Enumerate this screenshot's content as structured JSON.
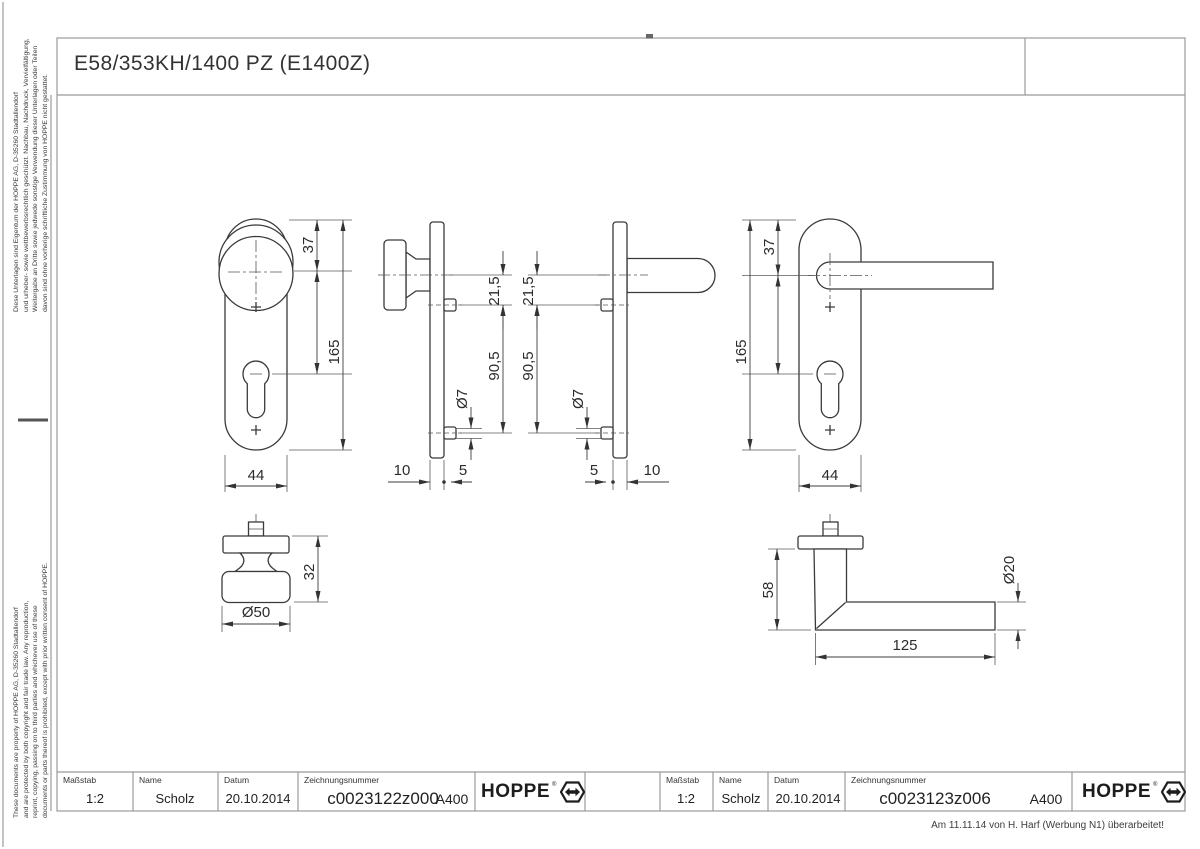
{
  "title": "E58/353KH/1400 PZ (E1400Z)",
  "revision_note": "Am 11.11.14 von H. Harf (Werbung N1) überarbeitet!",
  "brand": {
    "name": "HOPPE",
    "registered_mark": "®",
    "logo_icon": "hoppe-hexagon-arrow-icon"
  },
  "legal": {
    "german": [
      "Diese Unterlagen sind Eigentum der HOPPE AG, D-35260 Stadtallendorf",
      "und urheber- sowie wettbewerbsrechtlich geschützt. Nachbau, Nachdruck, Vervielfältigung,",
      "Weitergabe an Dritte sowie jedwede sonstige Verwendung dieser Unterlagen oder Teilen",
      "davon sind ohne vorherige schriftliche Zustimmung von HOPPE nicht gestattet."
    ],
    "english": [
      "These documents are property of HOPPE AG, D-35260 Stadtallendorf",
      "and are protected by both copyright and fair trade law. Any reproduction,",
      "reprint, copying, passing on to third parties and whichever use of these",
      "documents or parts thereof is prohibited, except with prior written consent of HOPPE."
    ]
  },
  "title_blocks": [
    {
      "scale_label": "Maßstab",
      "scale_value": "1:2",
      "name_label": "Name",
      "name_value": "Scholz",
      "date_label": "Datum",
      "date_value": "20.10.2014",
      "number_label": "Zeichnungsnummer",
      "number_value": "c0023122z000",
      "format_code": "A400"
    },
    {
      "scale_label": "Maßstab",
      "scale_value": "1:2",
      "name_label": "Name",
      "name_value": "Scholz",
      "date_label": "Datum",
      "date_value": "20.10.2014",
      "number_label": "Zeichnungsnummer",
      "number_value": "c0023123z006",
      "format_code": "A400"
    }
  ],
  "dims": {
    "knob_plate_front": {
      "offset_top": "37",
      "length": "165",
      "width": "44"
    },
    "knob_plate_side": {
      "center_to_hole": "21,5",
      "hole_to_hole": "90,5",
      "hole_dia": "Ø7",
      "knob_projection": "10",
      "plate_projection": "5"
    },
    "lever_plate_side": {
      "center_to_hole": "21,5",
      "hole_to_hole": "90,5",
      "hole_dia": "Ø7",
      "lever_projection": "10",
      "plate_projection": "5"
    },
    "lever_plate_front": {
      "offset_top": "37",
      "length": "165",
      "width": "44"
    },
    "knob_profile": {
      "height": "32",
      "dia": "Ø50"
    },
    "lever_profile": {
      "height": "58",
      "length": "125",
      "dia": "Ø20"
    }
  }
}
